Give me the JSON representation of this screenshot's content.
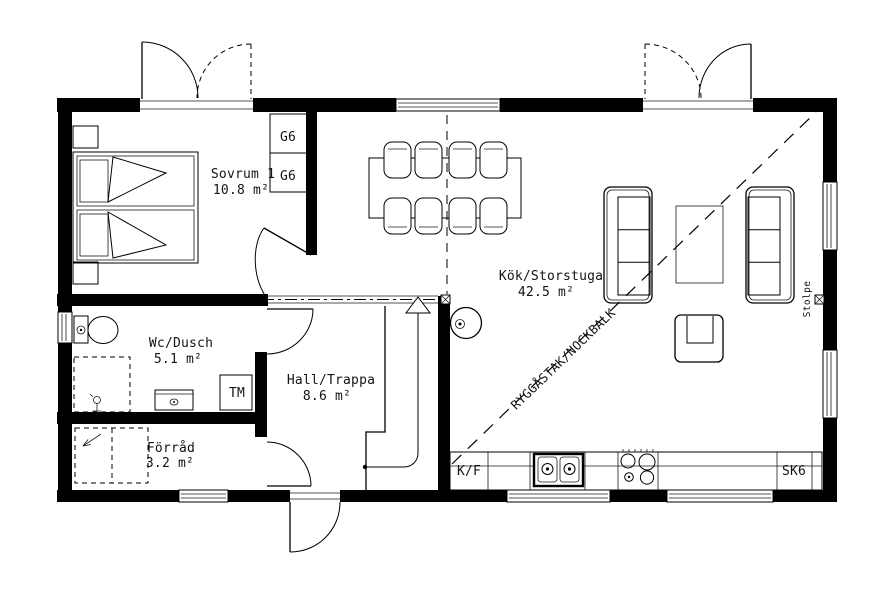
{
  "rooms": {
    "sovrum": {
      "name": "Sovrum 1",
      "area": "10.8 m²"
    },
    "wc": {
      "name": "Wc/Dusch",
      "area": "5.1 m²"
    },
    "hall": {
      "name": "Hall/Trappa",
      "area": "8.6 m²"
    },
    "forrad": {
      "name": "Förråd",
      "area": "3.2 m²"
    },
    "kok": {
      "name": "Kök/Storstuga",
      "area": "42.5 m²"
    }
  },
  "labels": {
    "wardrobe_1": "G6",
    "wardrobe_2": "G6",
    "washing_machine": "TM",
    "fridge_freezer": "K/F",
    "tall_cabinet": "SK6",
    "post": "Stolpe",
    "ridge_beam": "RYGGÅSTAK/NOCKBALK"
  },
  "colors": {
    "wall": "#000000",
    "line": "#1a1a1a",
    "background": "#ffffff"
  }
}
